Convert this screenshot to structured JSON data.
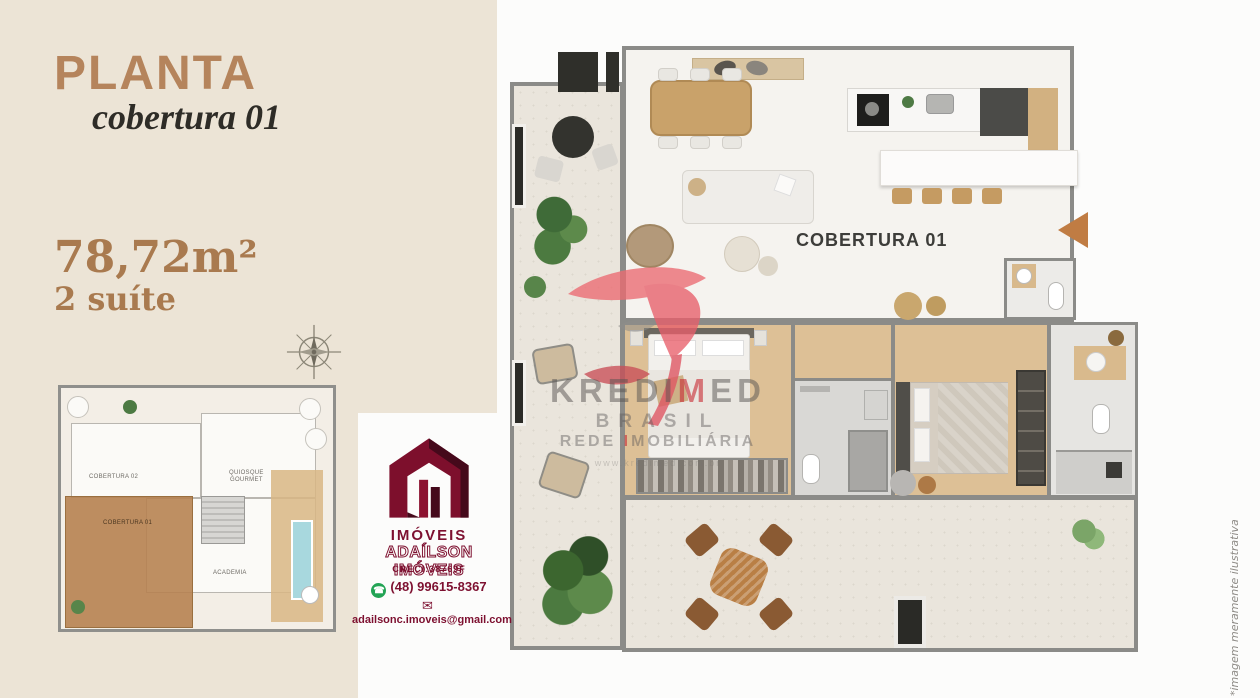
{
  "colors": {
    "background": "#ECE4D6",
    "accent_tan": "#B5845C",
    "accent_brown_text": "#A97A4F",
    "dark_text": "#2E2C27",
    "logo_maroon": "#7D1030",
    "whatsapp_green": "#23A455",
    "watermark_red": "#C82D37",
    "entry_arrow": "#C07C43",
    "wood_floor": "#DDC096",
    "wall_gray": "#8B8B88"
  },
  "left_panel": {
    "title": "PLANTA",
    "subtitle": "cobertura 01",
    "area": "78,72m²",
    "suites": "2 suíte"
  },
  "mini_plan": {
    "labels": {
      "cobertura02": "COBERTURA 02",
      "quiosque_gourmet": "QUIOSQUE\nGOURMET",
      "cobertura01": "COBERTURA 01",
      "academia": "ACADEMIA"
    }
  },
  "agency": {
    "logo_text": "IMÓVEIS",
    "name": "ADAÍLSON IMÓVEIS",
    "creci": "CRECI:38769F",
    "phone": "(48) 99615-8367",
    "email": "adailsonc.imoveis@gmail.com",
    "whatsapp_glyph": "☎",
    "envelope_glyph": "✉"
  },
  "floorplan": {
    "unit_label": "COBERTURA 01"
  },
  "watermark": {
    "brand_prefix": "KREDI",
    "brand_highlight": "M",
    "brand_suffix": "ED",
    "line2": "BRASIL",
    "line3_prefix": "REDE ",
    "line3_highlight": "I",
    "line3_suffix": "MOBILIÁRIA",
    "url": "www.kredimed.com.br"
  },
  "footnote": "*imagem meramente ilustrativa"
}
